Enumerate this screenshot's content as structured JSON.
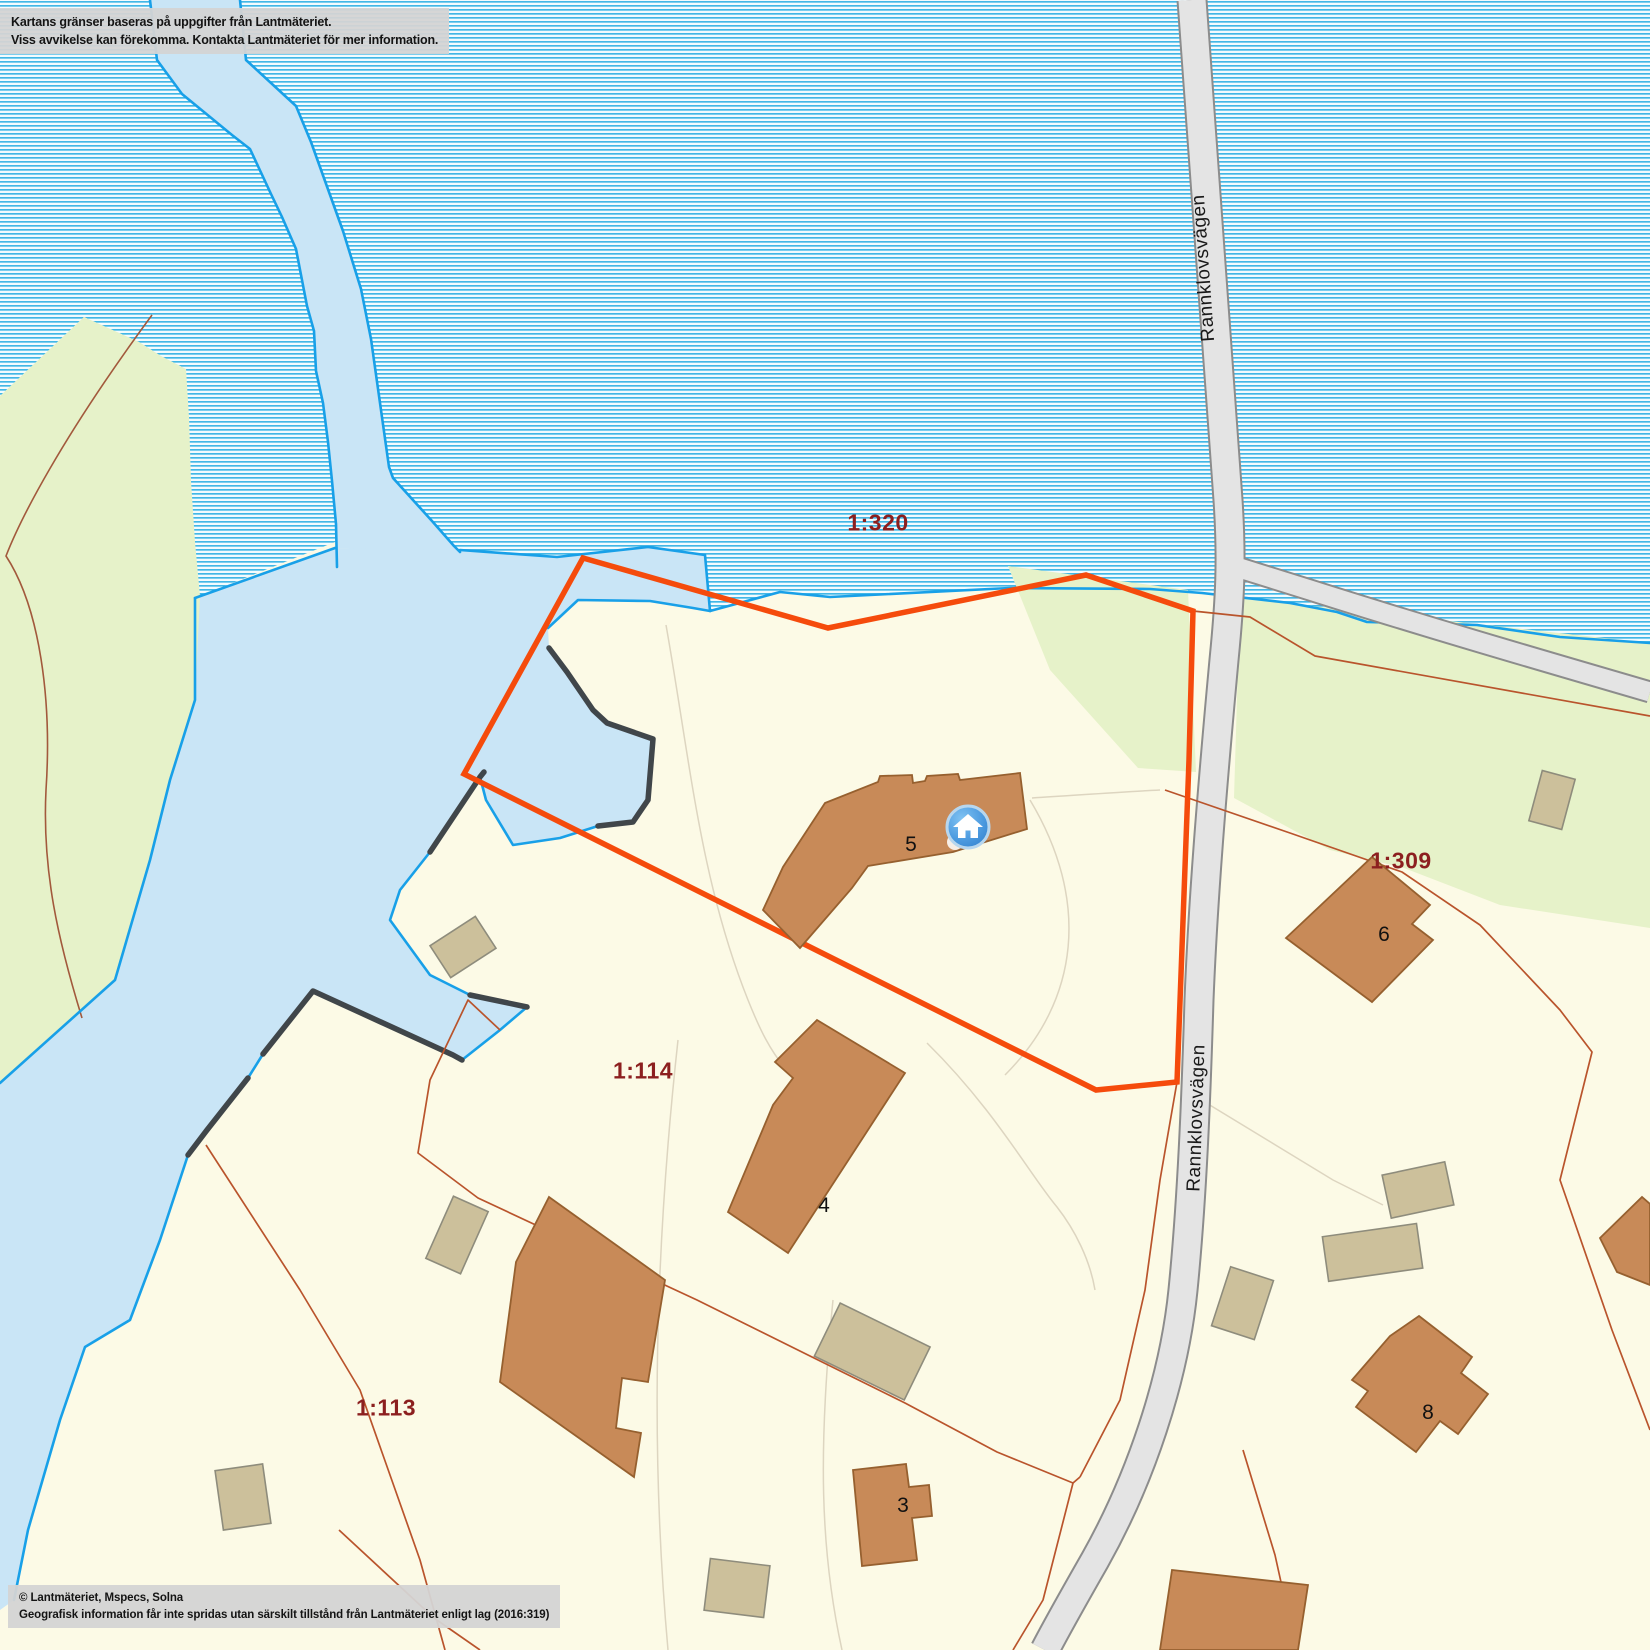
{
  "map": {
    "disclaimer": {
      "line1": "Kartans gränser baseras på uppgifter från Lantmäteriet.",
      "line2": "Viss avvikelse kan förekomma. Kontakta Lantmäteriet för mer information."
    },
    "attribution": {
      "line1": "© Lantmäteriet, Mspecs, Solna",
      "line2": "Geografisk information får inte spridas utan särskilt tillstånd från Lantmäteriet enligt lag (2016:319)"
    },
    "road_labels": [
      {
        "text": "Rannklovsvägen"
      },
      {
        "text": "Rannklovsvägen"
      }
    ],
    "parcel_labels": [
      {
        "text": "1:320"
      },
      {
        "text": "1:309"
      },
      {
        "text": "1:114"
      },
      {
        "text": "1:113"
      }
    ],
    "building_labels": [
      {
        "text": "5"
      },
      {
        "text": "4"
      },
      {
        "text": "6"
      },
      {
        "text": "3"
      },
      {
        "text": "8"
      }
    ],
    "marker": {
      "label": "home-marker"
    },
    "colors": {
      "land_cream": "#fcfae6",
      "water_solid": "#c9e5f6",
      "water_hatch_line": "#2eb0e4",
      "water_outline_cyan": "#18a0e8",
      "shore_dark": "#40464a",
      "green_area": "#e6f2c9",
      "road_fill": "#e4e4e4",
      "road_casing": "#8c8c8c",
      "property_boundary_orange": "#f54b0c",
      "parcel_line_sienna": "#b9542c",
      "contour_beige": "#ddd5c0",
      "building_brown": "#c88a58",
      "building_brown_stroke": "#96602f",
      "shed_tan": "#ccc09b",
      "shed_tan_stroke": "#8e8c7c",
      "parcel_label_maroon": "#8c1f1f",
      "marker_blue": "#3d8ed8",
      "note_box_gray": "#d4d4d4"
    }
  }
}
